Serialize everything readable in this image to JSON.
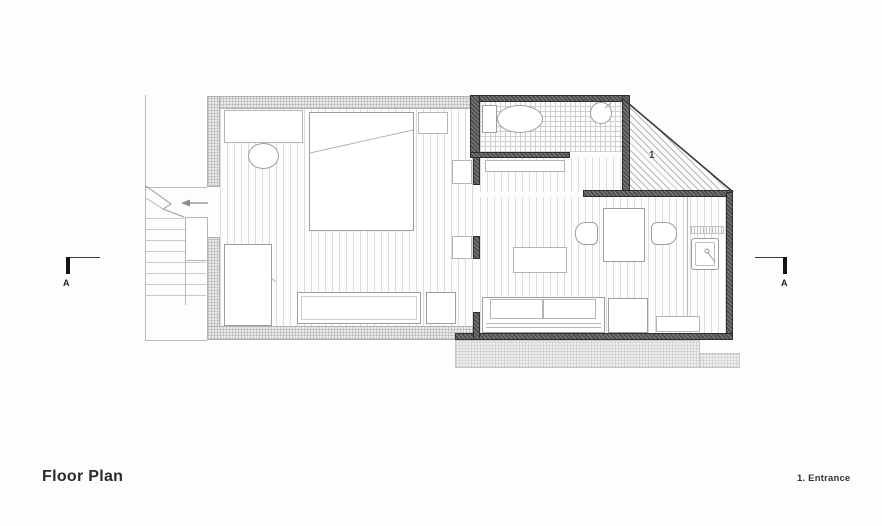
{
  "title": {
    "text": "Floor Plan"
  },
  "legend": {
    "item_1": "1. Entrance"
  },
  "markers": {
    "entrance_number": "1",
    "section_left": "A",
    "section_right": "A"
  },
  "colors": {
    "paper": "#fdfdfd",
    "ink": "#2b2b2b",
    "line": "#9e9e9e",
    "wall_dark": "#4f4f4f",
    "wall_light": "#eaeaea"
  }
}
